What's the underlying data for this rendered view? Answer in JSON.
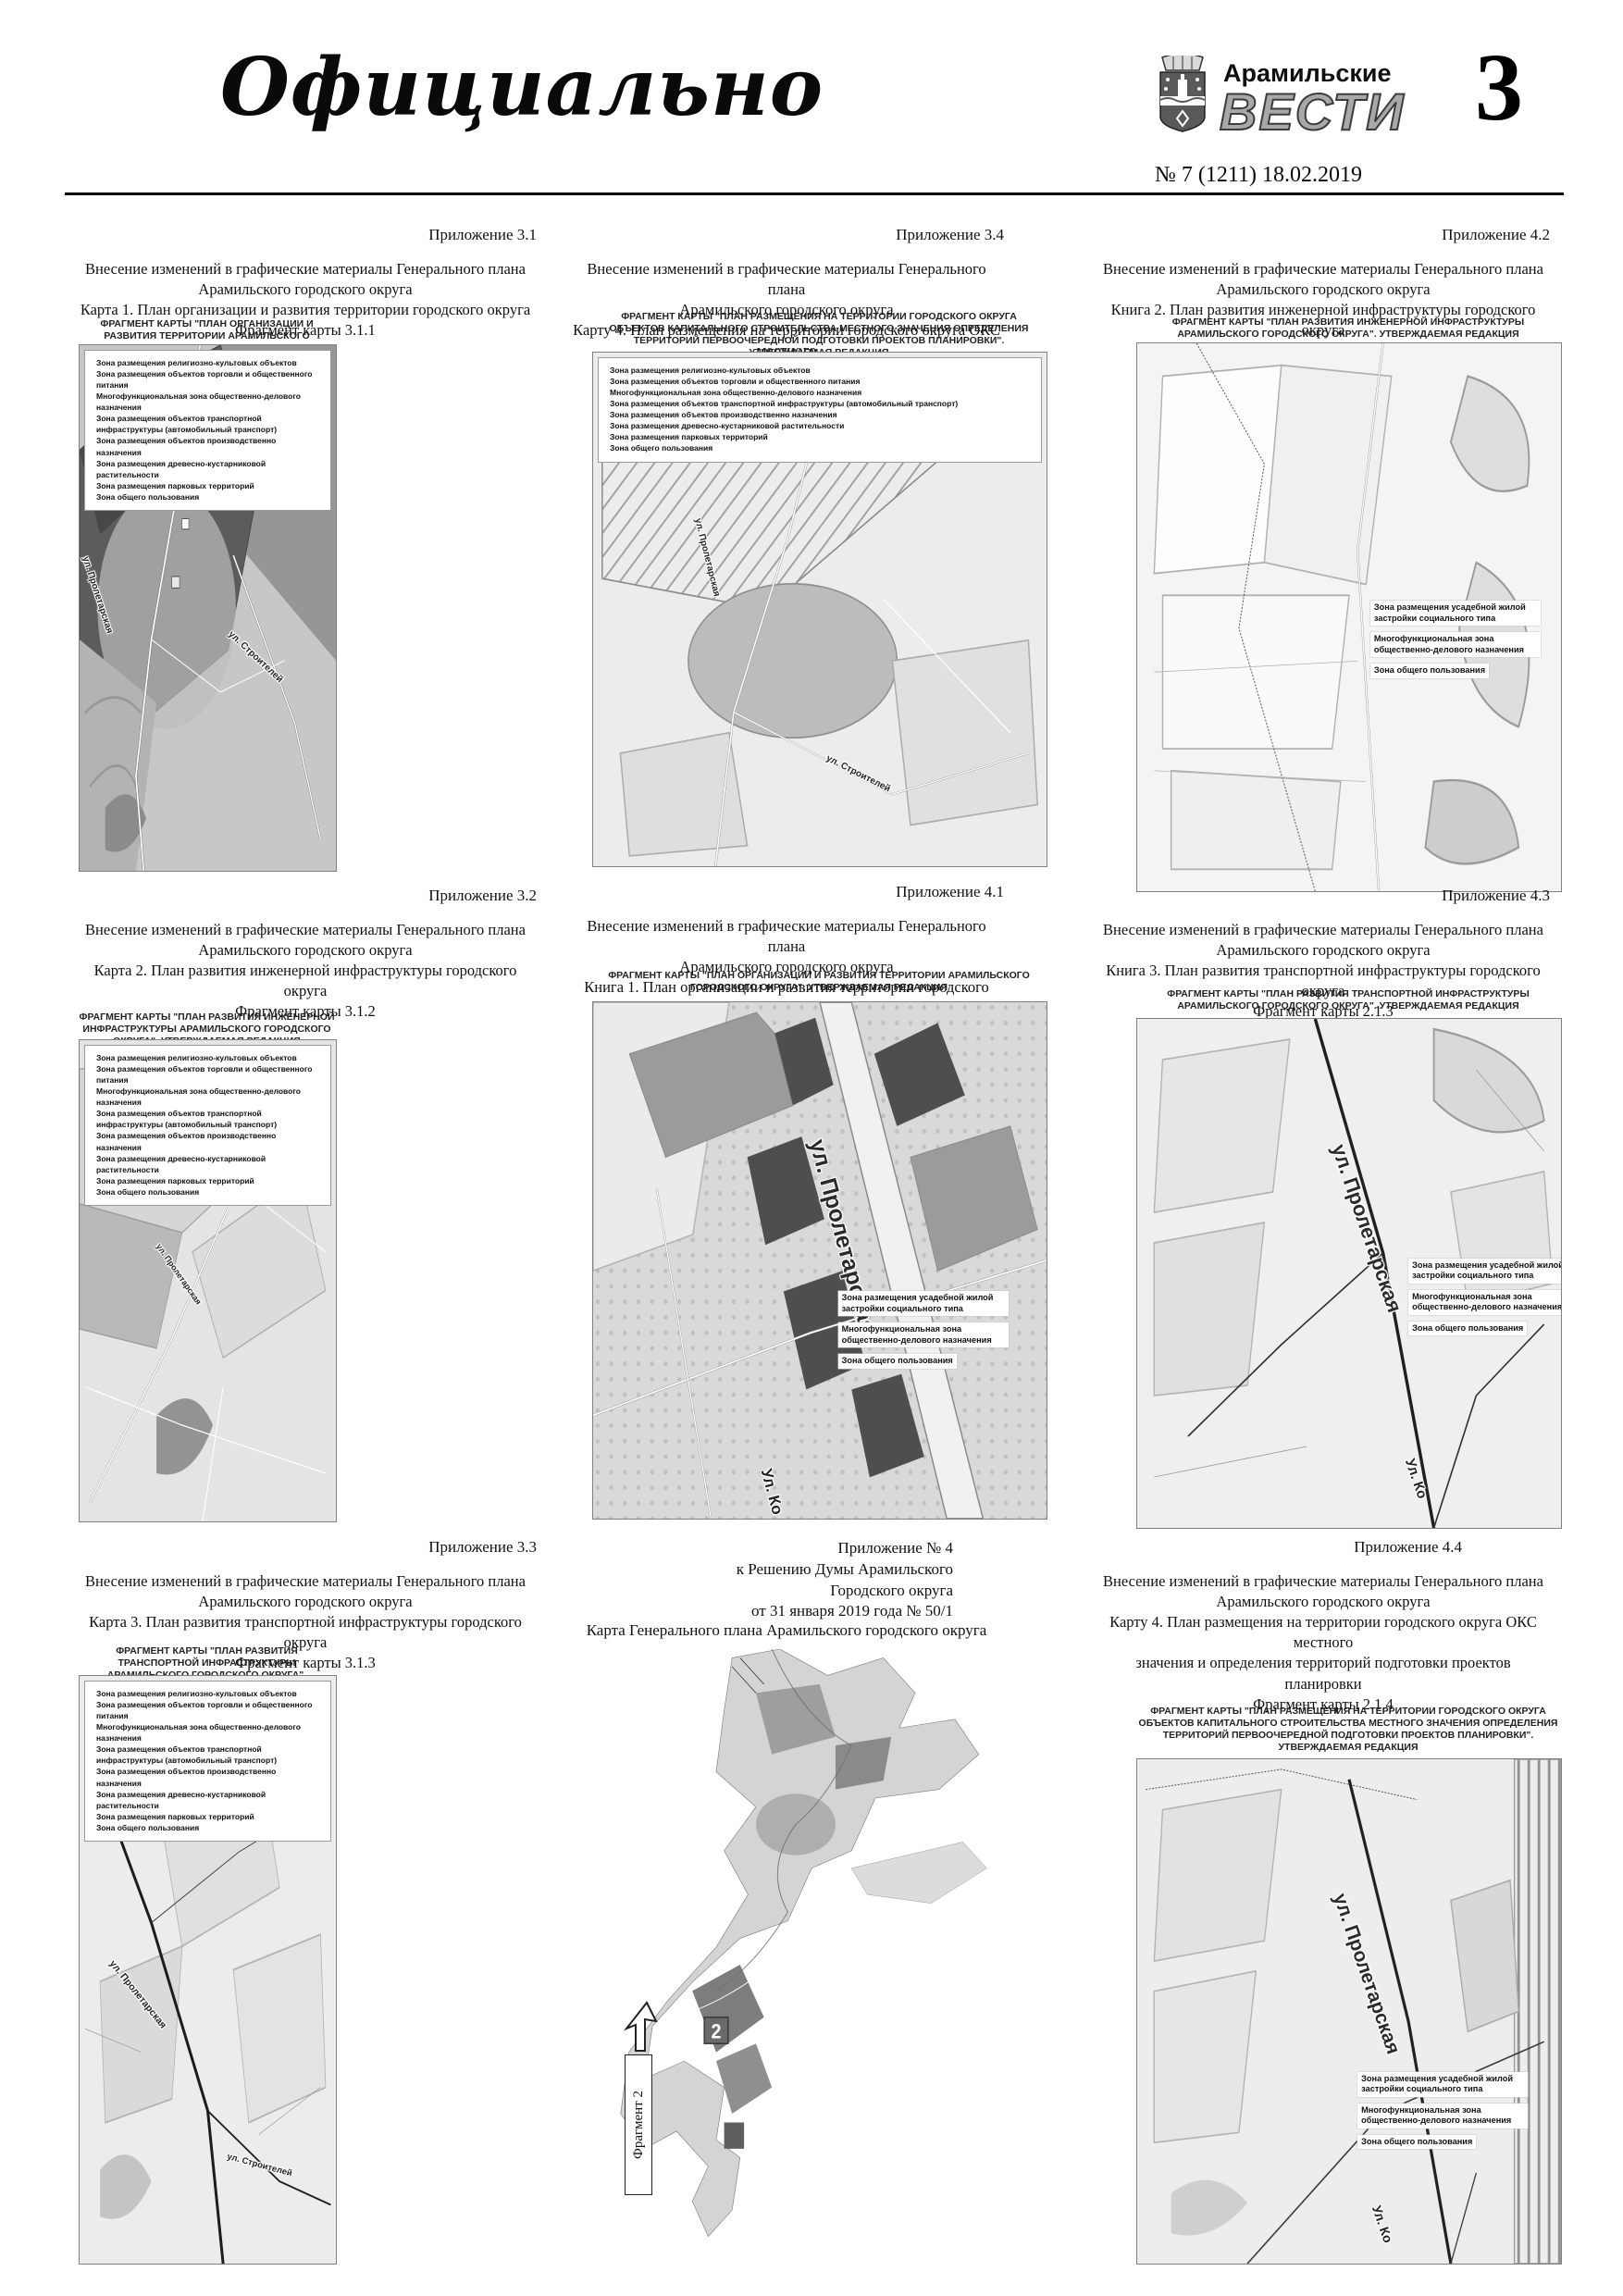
{
  "page": {
    "masthead": "Официально",
    "brand_top": "Арамильские",
    "brand_main": "ВЕСТИ",
    "issue": "№ 7 (1211) 18.02.2019",
    "number": "3"
  },
  "colors": {
    "page_bg": "#ffffff",
    "ink": "#000000",
    "brand_gray": "#a8a8a8",
    "map_dark_zone": "#5c5c5c",
    "map_light": "#ececec"
  },
  "legends": {
    "full": [
      "Зона размещения религиозно-культовых объектов",
      "Зона размещения объектов торговли и общественного питания",
      "Многофункциональная зона общественно-делового назначения",
      "Зона размещения объектов транспортной инфраструктуры (автомобильный транспорт)",
      "Зона размещения объектов производственно назначения",
      "Зона размещения древесно-кустарниковой растительности",
      "Зона размещения парковых территорий",
      "Зона общего пользования"
    ],
    "callout": [
      "Зона размещения усадебной жилой застройки социального типа",
      "Многофункциональная зона общественно-делового назначения",
      "Зона общего пользования"
    ]
  },
  "captions": {
    "org": "ФРАГМЕНТ КАРТЫ \"ПЛАН ОРГАНИЗАЦИИ И РАЗВИТИЯ ТЕРРИТОРИИ АРАМИЛЬСКОГО ГОРОДСКОГО ОКРУГА\". УТВЕРЖДАЕМАЯ РЕДАКЦИЯ",
    "eng": "ФРАГМЕНТ КАРТЫ \"ПЛАН РАЗВИТИЯ ИНЖЕНЕРНОЙ ИНФРАСТРУКТУРЫ АРАМИЛЬСКОГО ГОРОДСКОГО ОКРУГА\". УТВЕРЖДАЕМАЯ РЕДАКЦИЯ",
    "transp": "ФРАГМЕНТ КАРТЫ \"ПЛАН РАЗВИТИЯ ТРАНСПОРТНОЙ ИНФРАСТРУКТУРЫ АРАМИЛЬСКОГО ГОРОДСКОГО ОКРУГА\". УТВЕРЖДАЕМАЯ РЕДАКЦИЯ",
    "oks": "ФРАГМЕНТ КАРТЫ \"ПЛАН РАЗМЕЩЕНИЯ НА ТЕРРИТОРИИ ГОРОДСКОГО ОКРУГА ОБЪЕКТОВ КАПИТАЛЬНОГО СТРОИТЕЛЬСТВА МЕСТНОГО ЗНАЧЕНИЯ  ОПРЕДЕЛЕНИЯ ТЕРРИТОРИЙ ПЕРВООЧЕРЕДНОЙ ПОДГОТОВКИ ПРОЕКТОВ ПЛАНИРОВКИ\". УТВЕРЖДАЕМАЯ РЕДАКЦИЯ"
  },
  "blocks": [
    {
      "appendix": "Приложение 3.1",
      "title": [
        "Внесение изменений в графические материалы Генерального плана",
        "Арамильского городского округа",
        "Карта 1. План организации и развития территории городского округа",
        "Фрагмент карты 3.1.1"
      ],
      "streets": [
        "ул. Пролетарская",
        "ул. Строителей"
      ]
    },
    {
      "appendix": "Приложение 3.4",
      "title": [
        "Внесение изменений в графические материалы Генерального плана",
        "Арамильского городского округа",
        "Карту 4.  План размещения на территории городского округа ОКС местного",
        "значения и определения территорий подготовки проектов планировки",
        "Фрагмент карты 3.1.4"
      ],
      "streets": [
        "ул. Пролетарская",
        "ул. Строителей"
      ]
    },
    {
      "appendix": "Приложение 4.2",
      "title": [
        "Внесение изменений в графические материалы Генерального плана",
        "Арамильского городского округа",
        "Книга 2. План развития инженерной инфраструктуры городского округа",
        "Фрагмент карты 2.1.2"
      ],
      "streets": []
    },
    {
      "appendix": "Приложение 3.2",
      "title": [
        "Внесение изменений в графические материалы Генерального плана",
        "Арамильского городского округа",
        "Карта 2. План развития инженерной инфраструктуры городского округа",
        "Фрагмент карты 3.1.2"
      ],
      "streets": [
        "ул. Пролетарская"
      ]
    },
    {
      "appendix": "Приложение 4.1",
      "title": [
        "Внесение изменений в графические материалы Генерального плана",
        "Арамильского городского округа",
        "Книга 1. План организации и развития территории городского округа",
        "Фрагмент карты 2.1.1"
      ],
      "streets": [
        "ул. Пролетарская",
        "Ул. Ко"
      ]
    },
    {
      "appendix": "Приложение 4.3",
      "title": [
        "Внесение изменений в графические материалы Генерального плана",
        "Арамильского городского округа",
        "Книга 3. План развития транспортной инфраструктуры городского округа",
        "Фрагмент карты 2.1.3"
      ],
      "streets": [
        "ул. Пролетарская",
        "Ул. Ко"
      ]
    },
    {
      "appendix": "Приложение 3.3",
      "title": [
        "Внесение изменений в графические материалы Генерального плана",
        "Арамильского городского округа",
        "Карта 3. План развития транспортной инфраструктуры городского округа",
        "Фрагмент карты 3.1.3"
      ],
      "streets": [
        "ул. Пролетарская",
        "ул. Строителей"
      ]
    },
    {
      "appendix_lines": [
        "Приложение № 4",
        "к Решению Думы Арамильского",
        "Городского округа",
        "от 31 января 2019 года № 50/1"
      ],
      "map_title": "Карта Генерального плана Арамильского городского округа",
      "fragment_label": "Фрагмент 2",
      "fragment_marker": "2"
    },
    {
      "appendix": "Приложение 4.4",
      "title": [
        "Внесение изменений в графические материалы Генерального плана",
        "Арамильского городского округа",
        "Карту 4.  План размещения на территории городского округа ОКС местного",
        "значения и определения территорий подготовки проектов планировки",
        "Фрагмент карты 2.1.4"
      ],
      "streets": [
        "ул. Пролетарская",
        "Ул. Ко"
      ]
    }
  ]
}
